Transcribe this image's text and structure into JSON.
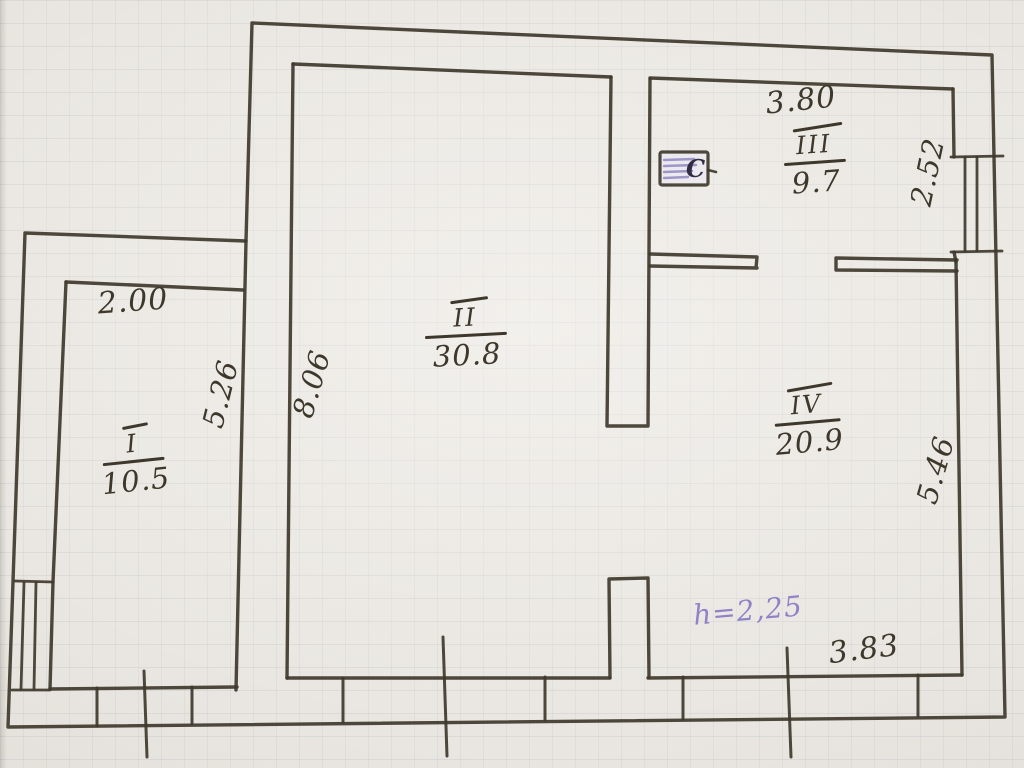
{
  "plan": {
    "rooms": [
      {
        "numeral": "I",
        "area": "10.5"
      },
      {
        "numeral": "II",
        "area": "30.8"
      },
      {
        "numeral": "III",
        "area": "9.7"
      },
      {
        "numeral": "IV",
        "area": "20.9"
      }
    ],
    "dimensions": {
      "room1_top": "2.00",
      "room1_side": "5.26",
      "room2_side": "8.06",
      "room3_top": "3.80",
      "room3_side": "2.52",
      "room4_side": "5.46",
      "room4_bottom": "3.83",
      "height_note": "h=2,25"
    },
    "stove_label": "C"
  },
  "colors": {
    "ink": "#3f382c",
    "purple_ink": "#8d83c6",
    "stove_hatch": "#968fc4",
    "paper": "#e9e6e1"
  }
}
